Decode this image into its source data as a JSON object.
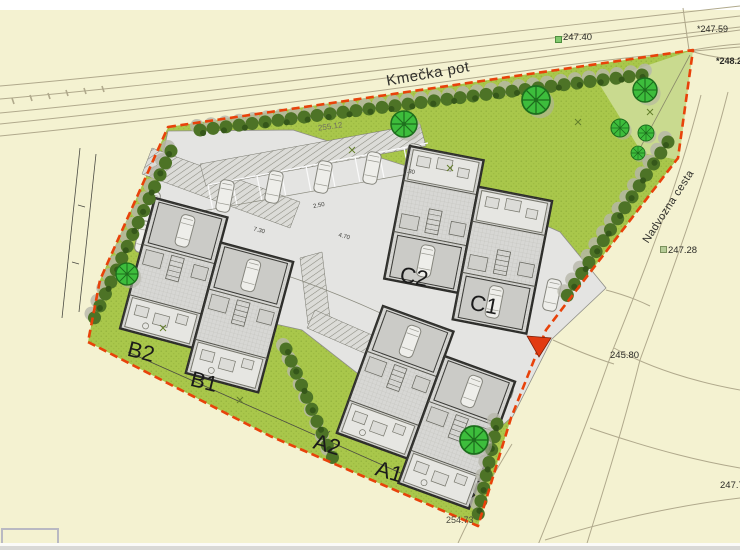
{
  "streets": {
    "top": "Kmečka pot",
    "right": "Nadvozna cesta"
  },
  "buildings": {
    "b2": "B2",
    "b1": "B1",
    "a2": "A2",
    "a1": "A1",
    "c2": "C2",
    "c1": "C1"
  },
  "elevations": {
    "e1": "247.40",
    "e2": "*247.59",
    "e3": "*248.2",
    "e4": "255.12",
    "e5": "247.28",
    "e6": "245.80",
    "e7": "254.73",
    "e8": "247.7"
  },
  "dimensions": {
    "d1": "7.30",
    "d2": "2.50",
    "d3": "4.70",
    "d4": "7.30"
  },
  "colors": {
    "background": "#f4f2d1",
    "lawn": "#a9c74b",
    "lawn_dark": "#90af3b",
    "hedge": "#4d7326",
    "tree": "#3dbd3c",
    "pavement": "#e4e4e2",
    "building_fill": "#d7d7d4",
    "wall": "#2d2d2a",
    "boundary": "#e8420a",
    "road_line": "#b0a98c"
  }
}
